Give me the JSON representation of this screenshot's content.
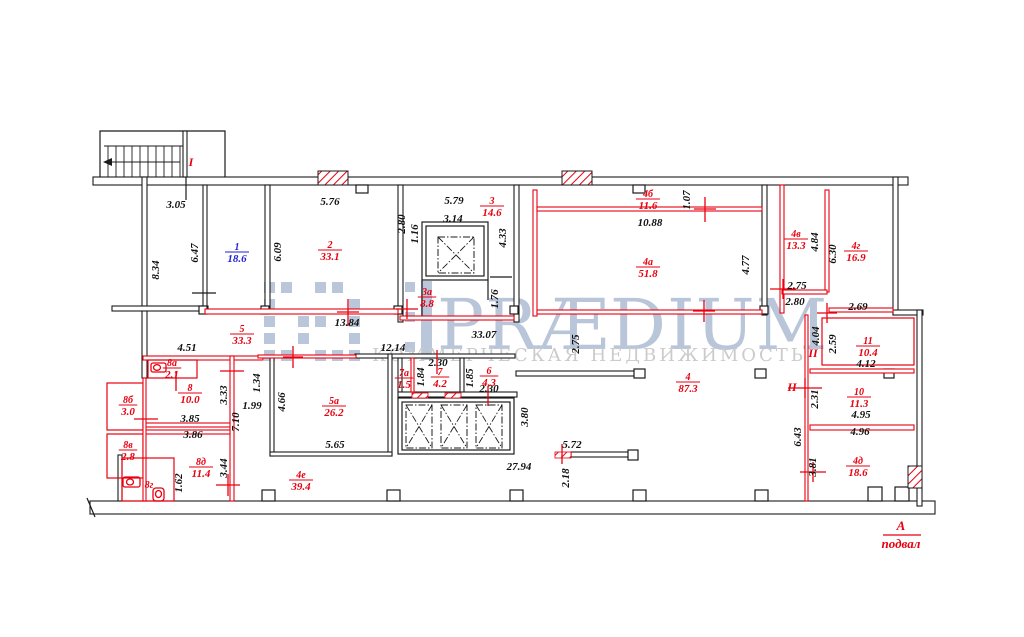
{
  "watermark": {
    "brand": "PRÆDIUM",
    "tagline": "КОММЕРЧЕСКАЯ НЕДВИЖИМОСТЬ"
  },
  "section_marker": {
    "letter": "А",
    "caption": "подвал"
  },
  "colors": {
    "wall_black": "#1b1b1b",
    "wall_red": "#e8000f",
    "room_red": "#e8000f",
    "room_blue": "#1f1fd4",
    "dim_text": "#111111",
    "watermark_brand": "#b6c3d8",
    "watermark_tagline": "#cbcbcb"
  },
  "markers": [
    {
      "text": "I",
      "x": 191,
      "y": 166
    },
    {
      "text": "II",
      "x": 813,
      "y": 357
    },
    {
      "text": "II",
      "x": 792,
      "y": 391
    }
  ],
  "rooms": [
    {
      "num": "1",
      "area": "18.6",
      "x": 237,
      "y": 252,
      "c": "blue"
    },
    {
      "num": "2",
      "area": "33.1",
      "x": 330,
      "y": 250
    },
    {
      "num": "3",
      "area": "14.6",
      "x": 492,
      "y": 206
    },
    {
      "num": "3а",
      "area": "8.8",
      "x": 427,
      "y": 297
    },
    {
      "num": "4б",
      "area": "11.6",
      "x": 648,
      "y": 199
    },
    {
      "num": "4а",
      "area": "51.8",
      "x": 648,
      "y": 267
    },
    {
      "num": "4в",
      "area": "13.3",
      "x": 796,
      "y": 239
    },
    {
      "num": "4г",
      "area": "16.9",
      "x": 856,
      "y": 251
    },
    {
      "num": "11",
      "area": "10.4",
      "x": 868,
      "y": 346
    },
    {
      "num": "10",
      "area": "11.3",
      "x": 859,
      "y": 397
    },
    {
      "num": "4д",
      "area": "18.6",
      "x": 858,
      "y": 466
    },
    {
      "num": "4",
      "area": "87.3",
      "x": 688,
      "y": 382
    },
    {
      "num": "5",
      "area": "33.3",
      "x": 242,
      "y": 334
    },
    {
      "num": "5а",
      "area": "26.2",
      "x": 334,
      "y": 406
    },
    {
      "num": "7а",
      "area": "1.5",
      "x": 404,
      "y": 378
    },
    {
      "num": "7",
      "area": "4.2",
      "x": 440,
      "y": 377
    },
    {
      "num": "6",
      "area": "4.3",
      "x": 489,
      "y": 376
    },
    {
      "num": "8а",
      "area": "2.1",
      "x": 172,
      "y": 368
    },
    {
      "num": "8",
      "area": "10.0",
      "x": 190,
      "y": 393
    },
    {
      "num": "8б",
      "area": "3.0",
      "x": 128,
      "y": 405
    },
    {
      "num": "8в",
      "area": "2.8",
      "x": 128,
      "y": 450
    },
    {
      "num": "8д",
      "area": "11.4",
      "x": 201,
      "y": 467
    },
    {
      "num": "8г",
      "area": "",
      "x": 149,
      "y": 490
    },
    {
      "num": "4е",
      "area": "39.4",
      "x": 301,
      "y": 480
    }
  ],
  "dimensions": [
    {
      "t": "3.05",
      "x": 176,
      "y": 208
    },
    {
      "t": "8.34",
      "x": 159,
      "y": 270,
      "v": 1
    },
    {
      "t": "6.47",
      "x": 198,
      "y": 253,
      "v": 1
    },
    {
      "t": "6.09",
      "x": 281,
      "y": 252,
      "v": 1
    },
    {
      "t": "5.76",
      "x": 330,
      "y": 205
    },
    {
      "t": "13.84",
      "x": 347,
      "y": 326
    },
    {
      "t": "2.80",
      "x": 405,
      "y": 224,
      "v": 1
    },
    {
      "t": "1.16",
      "x": 418,
      "y": 234,
      "v": 1
    },
    {
      "t": "5.79",
      "x": 454,
      "y": 204
    },
    {
      "t": "3.14",
      "x": 453,
      "y": 222
    },
    {
      "t": "4.33",
      "x": 506,
      "y": 238,
      "v": 1
    },
    {
      "t": "1.76",
      "x": 498,
      "y": 299,
      "v": 1
    },
    {
      "t": "33.07",
      "x": 484,
      "y": 338
    },
    {
      "t": "2.75",
      "x": 579,
      "y": 344,
      "v": 1
    },
    {
      "t": "12.14",
      "x": 393,
      "y": 351
    },
    {
      "t": "1.07",
      "x": 690,
      "y": 200,
      "v": 1
    },
    {
      "t": "10.88",
      "x": 650,
      "y": 226
    },
    {
      "t": "4.77",
      "x": 749,
      "y": 265,
      "v": 1
    },
    {
      "t": "4.84",
      "x": 818,
      "y": 242,
      "v": 1
    },
    {
      "t": "6.30",
      "x": 836,
      "y": 254,
      "v": 1
    },
    {
      "t": "2.75",
      "x": 797,
      "y": 289
    },
    {
      "t": "2.80",
      "x": 795,
      "y": 305
    },
    {
      "t": "2.69",
      "x": 858,
      "y": 310
    },
    {
      "t": "4.04",
      "x": 819,
      "y": 336,
      "v": 1
    },
    {
      "t": "2.59",
      "x": 836,
      "y": 344,
      "v": 1
    },
    {
      "t": "4.12",
      "x": 866,
      "y": 367
    },
    {
      "t": "2.31",
      "x": 818,
      "y": 399,
      "v": 1
    },
    {
      "t": "4.95",
      "x": 861,
      "y": 418
    },
    {
      "t": "4.96",
      "x": 860,
      "y": 435
    },
    {
      "t": "6.43",
      "x": 801,
      "y": 437,
      "v": 1
    },
    {
      "t": "3.81",
      "x": 816,
      "y": 467,
      "v": 1
    },
    {
      "t": "3.80",
      "x": 528,
      "y": 417,
      "v": 1
    },
    {
      "t": "5.72",
      "x": 572,
      "y": 448
    },
    {
      "t": "27.94",
      "x": 519,
      "y": 470
    },
    {
      "t": "2.18",
      "x": 569,
      "y": 478,
      "v": 1
    },
    {
      "t": "4.66",
      "x": 285,
      "y": 402,
      "v": 1
    },
    {
      "t": "5.65",
      "x": 335,
      "y": 448
    },
    {
      "t": "2.30",
      "x": 438,
      "y": 366
    },
    {
      "t": "1.84",
      "x": 424,
      "y": 377,
      "v": 1
    },
    {
      "t": "1.85",
      "x": 473,
      "y": 378,
      "v": 1
    },
    {
      "t": "2.30",
      "x": 489,
      "y": 392
    },
    {
      "t": "4.51",
      "x": 187,
      "y": 351
    },
    {
      "t": "3.33",
      "x": 227,
      "y": 395,
      "v": 1
    },
    {
      "t": "1.34",
      "x": 260,
      "y": 383,
      "v": 1
    },
    {
      "t": "1.99",
      "x": 252,
      "y": 409
    },
    {
      "t": "3.85",
      "x": 190,
      "y": 422
    },
    {
      "t": "7.10",
      "x": 239,
      "y": 422,
      "v": 1
    },
    {
      "t": "3.86",
      "x": 193,
      "y": 438
    },
    {
      "t": "3.44",
      "x": 227,
      "y": 468,
      "v": 1
    },
    {
      "t": "1.62",
      "x": 182,
      "y": 483,
      "v": 1
    }
  ]
}
